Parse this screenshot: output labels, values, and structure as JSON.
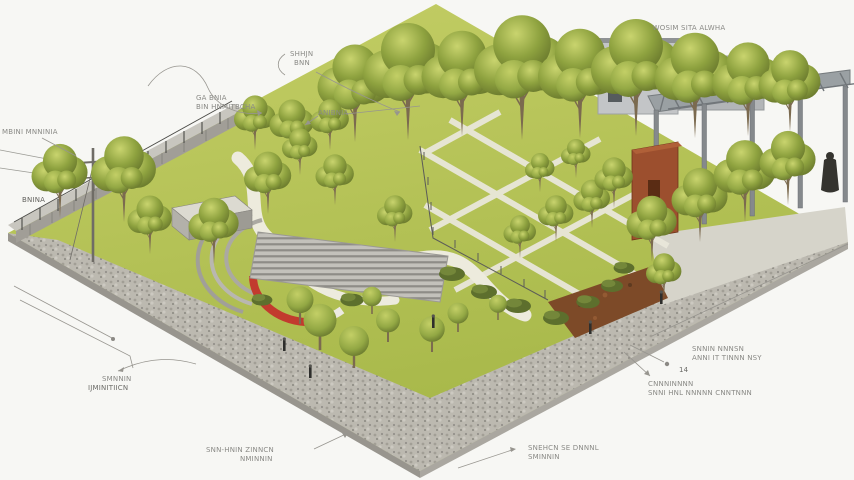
{
  "colors": {
    "background": "#f7f7f4",
    "lawn": "#b4c156",
    "path": "#edebdd",
    "gravel": "#bcb9b0",
    "stone": "#a4a19a",
    "concrete": "#d6d4ca",
    "rust": "#9c4f2e",
    "pergola": "#8d9295",
    "building": "#c0c2c4",
    "red_accent": "#c23b2e",
    "mulch": "#7d4a28",
    "label": "#8a8a86",
    "leader": "#97958f"
  },
  "annotations": {
    "top_right": {
      "line1": "WOSIM SITA ALWHA"
    },
    "brace": {
      "line1": "SHHJN",
      "line2": "BNN"
    },
    "upper_left": {
      "line1": "GA BNIA",
      "line2": "BIN HNMITBCHA"
    },
    "small_mid": {
      "line1": "ANIBNIA"
    },
    "pole": {
      "line1": "MBINI MNNINIA"
    },
    "pole_base": {
      "line1": "BNINA"
    },
    "bottom_left": {
      "line1": "SMNNIN",
      "line2": "IJMINITIICN"
    },
    "bottom_center": {
      "line1": "SNN-HNIN ZINNCN",
      "line2": "NMINNIN"
    },
    "bottom_right": {
      "line1": "SNEHCN SE DNNNL",
      "line2": "SMINNIN"
    },
    "right_upper": {
      "line1": "SNNIN NNNSN",
      "line2": "ANNI IT TINNN NSY"
    },
    "right_lower": {
      "line1": "CNNNINNNN",
      "line2": "SNNI HNL NNNNN CNNTNNN"
    },
    "marker_14": {
      "line1": "14"
    }
  }
}
